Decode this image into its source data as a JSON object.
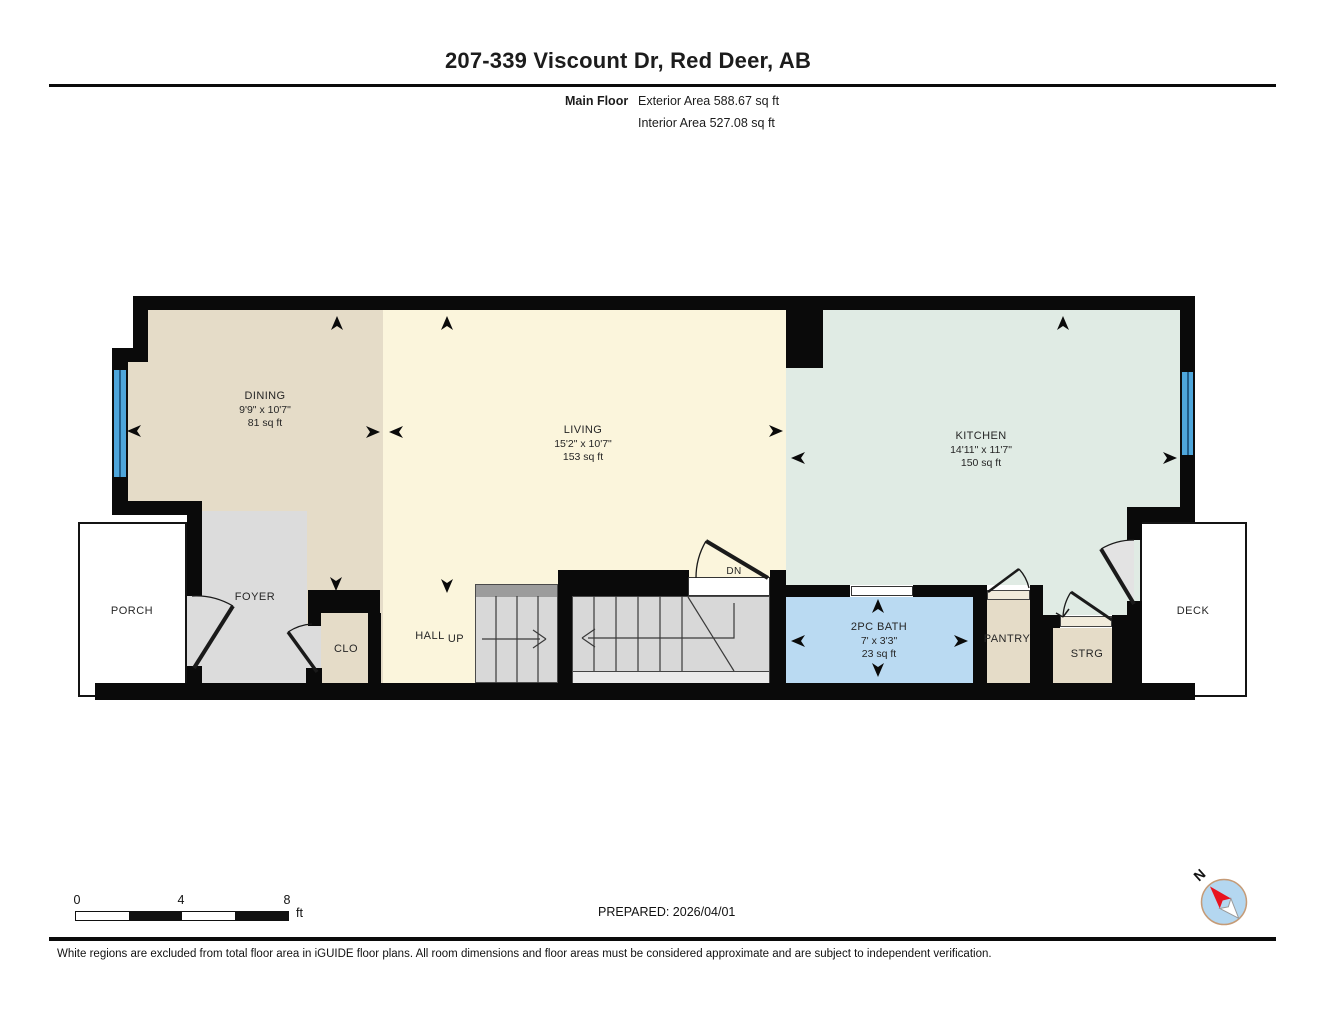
{
  "header": {
    "title": "207-339 Viscount Dr, Red Deer, AB",
    "floor_label": "Main Floor",
    "exterior_area": "Exterior Area 588.67 sq ft",
    "interior_area": "Interior Area 527.08 sq ft"
  },
  "rooms": {
    "dining": {
      "name": "DINING",
      "dims": "9'9\" x 10'7\"",
      "area": "81 sq ft"
    },
    "living": {
      "name": "LIVING",
      "dims": "15'2\" x 10'7\"",
      "area": "153 sq ft"
    },
    "kitchen": {
      "name": "KITCHEN",
      "dims": "14'11\" x 11'7\"",
      "area": "150 sq ft"
    },
    "bath": {
      "name": "2PC BATH",
      "dims": "7' x 3'3\"",
      "area": "23 sq ft"
    },
    "porch": {
      "name": "PORCH"
    },
    "foyer": {
      "name": "FOYER"
    },
    "closet": {
      "name": "CLO"
    },
    "hall": {
      "name": "HALL"
    },
    "up": {
      "name": "UP"
    },
    "dn": {
      "name": "DN"
    },
    "pantry": {
      "name": "PANTRY"
    },
    "storage": {
      "name": "STRG"
    },
    "deck": {
      "name": "DECK"
    }
  },
  "scale_bar": {
    "start": "0",
    "mid": "4",
    "end": "8",
    "unit": "ft"
  },
  "compass": {
    "north_label": "N"
  },
  "footer": {
    "prepared": "PREPARED: 2026/04/01",
    "disclaimer": "White regions are excluded from total floor area in iGUIDE floor plans. All room dimensions and floor areas must be considered approximate and are subject to independent verification."
  },
  "colors": {
    "walls": "#0a0a0a",
    "dining_tan": "#e5dcc8",
    "living_cream": "#fbf5dc",
    "kitchen_mint": "#e0ebe4",
    "bath_blue": "#badaf2",
    "foyer_gray": "#dcdcdc",
    "stair_gray": "#d8d8d8",
    "window_blue": "#4ea6db",
    "compass_red": "#e8131f",
    "compass_blue": "#b4d7f0"
  }
}
